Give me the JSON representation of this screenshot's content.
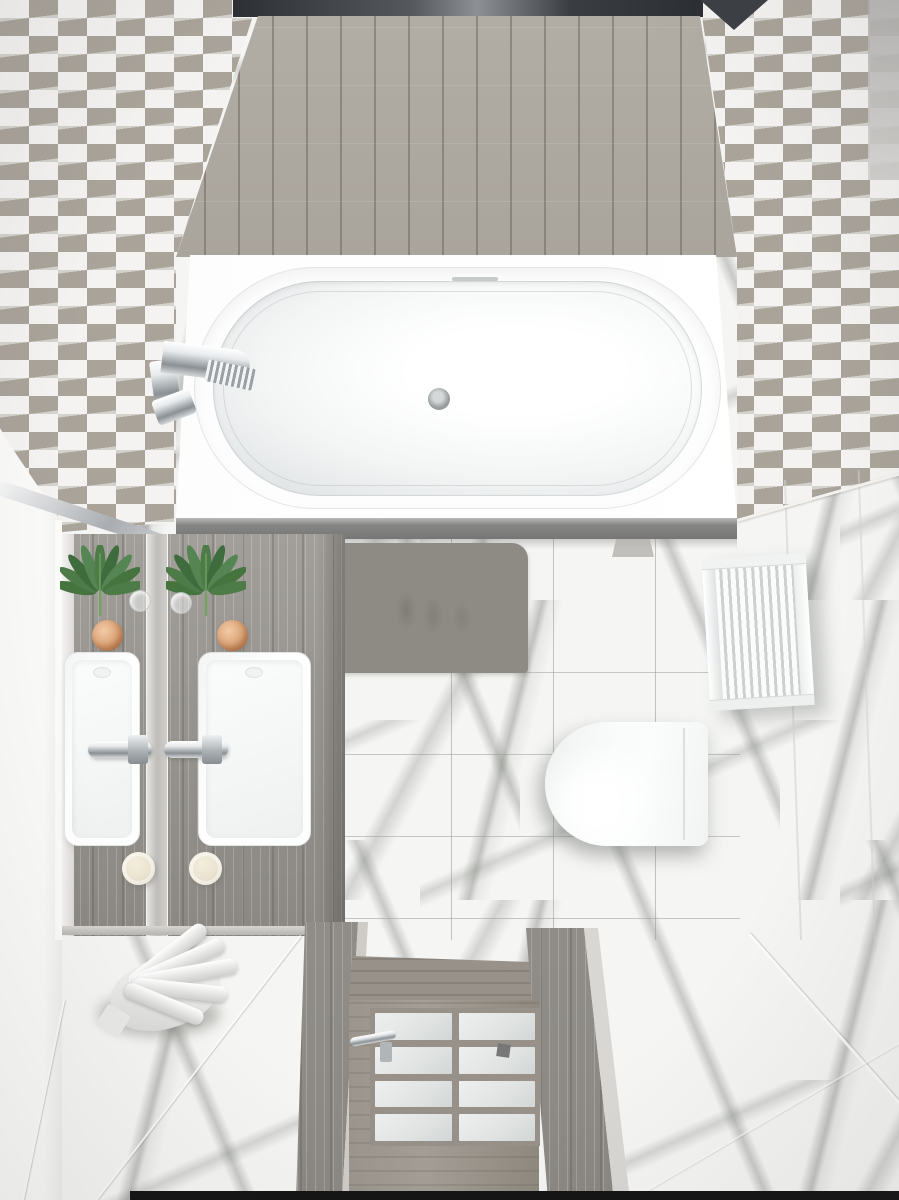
{
  "meta": {
    "title": "Top-down 3D render of a bathroom interior",
    "view": "bird's-eye"
  },
  "colors": {
    "marble_base": "#f5f5f3",
    "marble_vein": "#70746f",
    "grout_line": "#9c9e9b",
    "chevron_bg": "#f4f3f1",
    "chevron_diamond": "#a9a39a",
    "ceiling_dark": "#2b2e33",
    "ceiling_wood": "#b2ada5",
    "tub_white": "#fdfdfd",
    "basin_shade": "#dde0e1",
    "apron": "#858584",
    "mat": "#8e8b85",
    "counter_wood": "#a29f9a",
    "counter_wood_dark": "#8b8883",
    "sink_white": "#fcfdfd",
    "leaf": "#4d7c49",
    "leaf_dark": "#3e6c3c",
    "stem": "#75a161",
    "copper": "#d9a175",
    "candle": "#e9e2cf",
    "toilet": "#fbfcfc",
    "radiator": "#f6f7f7",
    "radiator_fin": "#cdd0d1",
    "door_wood": "#a49e96",
    "door_glass": "#e0e3e2",
    "towel": "#f2f2f0",
    "bottom_strip": "#141414"
  },
  "objects": [
    {
      "name": "bathtub",
      "label": "Freestanding oval bathtub"
    },
    {
      "name": "tub-faucet",
      "label": "Chrome tub faucet"
    },
    {
      "name": "bath-mat",
      "label": "Gray bath mat with wet footprints"
    },
    {
      "name": "vanity-counter",
      "label": "Weathered gray wood vanity counter"
    },
    {
      "name": "vessel-sink",
      "label": "White rectangular vessel sink",
      "count": 2
    },
    {
      "name": "sink-faucet",
      "label": "Chrome sink mixer",
      "count": 2
    },
    {
      "name": "monstera-plant",
      "label": "Monstera leaf in glass vase",
      "count": 2
    },
    {
      "name": "copper-candle",
      "label": "Copper candle holder",
      "count": 2
    },
    {
      "name": "cream-candle",
      "label": "Cream pillar candle",
      "count": 2
    },
    {
      "name": "toilet",
      "label": "Wall-hung toilet seen from above"
    },
    {
      "name": "radiator",
      "label": "White towel radiator on marble wall"
    },
    {
      "name": "door",
      "label": "Wood door with frosted glass panes"
    },
    {
      "name": "door-handle",
      "label": "Chrome door handle"
    },
    {
      "name": "towel",
      "label": "Crumpled white towel on floor"
    },
    {
      "name": "ceiling-panel",
      "label": "Gray wood plank ceiling panel"
    },
    {
      "name": "wall-tile",
      "label": "White and taupe chevron wall tile"
    },
    {
      "name": "floor-tile",
      "label": "White marble tile with gray veining"
    }
  ]
}
